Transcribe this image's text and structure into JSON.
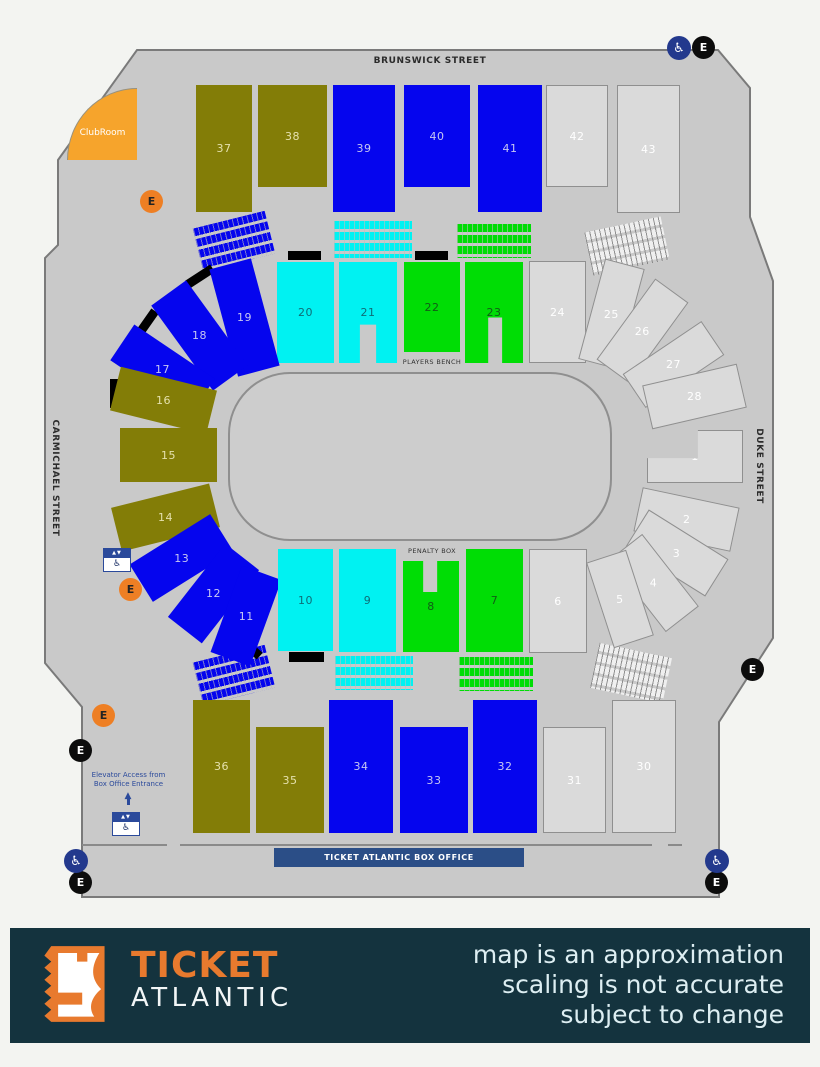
{
  "streets": {
    "top": "BRUNSWICK STREET",
    "left": "CARMICHAEL STREET",
    "right": "DUKE STREET"
  },
  "labels": {
    "club_room": "ClubRoom",
    "players_bench": "PLAYERS BENCH",
    "penalty_box": "PENALTY BOX",
    "box_office": "TICKET ATLANTIC BOX OFFICE",
    "elevator_note_line1": "Elevator Access from",
    "elevator_note_line2": "Box Office Entrance",
    "exit_letter": "E",
    "wheelchair_glyph": "♿",
    "elevator_top_glyph": "▲▼",
    "elevator_bottom_glyph": "♿",
    "arrow_glyph": "▲"
  },
  "footer": {
    "brand_line1": "TICKET",
    "brand_line2": "ATLANTIC",
    "disclaimer_lines": [
      "map is an approximation",
      "scaling is not accurate",
      "subject to change"
    ]
  },
  "colors": {
    "olive": "#837d07",
    "blue": "#0505ee",
    "cyan": "#00f2f2",
    "green": "#00dd05",
    "grey": "#dadada",
    "grey_border": "#8f8f8f",
    "building": "#c9c9c9",
    "building_border": "#7a7a7a",
    "orange": "#ee7f24",
    "clubroom_orange": "#f6a42c",
    "footer_navy": "#14333e",
    "footer_orange": "#e87a2e",
    "boxoffice_blue": "#2b4e87",
    "elevator_blue": "#2b4a9b",
    "wheelchair_blue": "#23398d",
    "label_on_olive": "#e5e1ad",
    "label_on_blue": "#c7c7f2",
    "label_on_cyan": "#0e6d77",
    "label_on_green": "#115c17",
    "label_on_grey": "#ffffff"
  },
  "building_outline": "137,50 718,50 750,88 750,217 773,281 773,638 719,722 719,897 82,897 82,707 45,663 45,258 58,245 58,160",
  "sections": [
    {
      "id": "37",
      "color": "olive",
      "x": 196,
      "y": 85,
      "w": 56,
      "h": 127
    },
    {
      "id": "38",
      "color": "olive",
      "x": 258,
      "y": 85,
      "w": 69,
      "h": 102
    },
    {
      "id": "39",
      "color": "blue",
      "x": 333,
      "y": 85,
      "w": 62,
      "h": 127
    },
    {
      "id": "40",
      "color": "blue",
      "x": 404,
      "y": 85,
      "w": 66,
      "h": 102
    },
    {
      "id": "41",
      "color": "blue",
      "x": 478,
      "y": 85,
      "w": 64,
      "h": 127
    },
    {
      "id": "42",
      "color": "grey",
      "x": 546,
      "y": 85,
      "w": 62,
      "h": 102,
      "border": true
    },
    {
      "id": "43",
      "color": "grey",
      "x": 617,
      "y": 85,
      "w": 63,
      "h": 128,
      "border": true
    },
    {
      "id": "20",
      "color": "cyan",
      "x": 277,
      "y": 262,
      "w": 57,
      "h": 101
    },
    {
      "id": "21",
      "color": "cyan",
      "x": 339,
      "y": 262,
      "w": 58,
      "h": 101,
      "clip": "polygon(0 0,100% 0,100% 100%,64% 100%,64% 62%,36% 62%,36% 100%,0 100%)"
    },
    {
      "id": "22",
      "color": "green",
      "x": 404,
      "y": 262,
      "w": 56,
      "h": 90
    },
    {
      "id": "23",
      "color": "green",
      "x": 465,
      "y": 262,
      "w": 58,
      "h": 101,
      "clip": "polygon(0 0,100% 0,100% 100%,64% 100%,64% 55%,40% 55%,40% 100%,0 100%)"
    },
    {
      "id": "24",
      "color": "grey",
      "x": 529,
      "y": 261,
      "w": 57,
      "h": 102,
      "border": true
    },
    {
      "id": "19",
      "color": "blue",
      "x": 223,
      "y": 262,
      "w": 43,
      "h": 111,
      "rot": -15
    },
    {
      "id": "18",
      "color": "blue",
      "x": 178,
      "y": 283,
      "w": 43,
      "h": 105,
      "rot": -36
    },
    {
      "id": "17",
      "color": "blue",
      "x": 141,
      "y": 321,
      "w": 43,
      "h": 97,
      "rot": -56
    },
    {
      "id": "16",
      "color": "olive",
      "x": 114,
      "y": 378,
      "w": 99,
      "h": 45,
      "rot": 14
    },
    {
      "id": "15",
      "color": "olive",
      "x": 120,
      "y": 428,
      "w": 97,
      "h": 54,
      "rot": 0
    },
    {
      "id": "14",
      "color": "olive",
      "x": 115,
      "y": 495,
      "w": 101,
      "h": 45,
      "rot": -14
    },
    {
      "id": "13",
      "color": "blue",
      "x": 134,
      "y": 536,
      "w": 95,
      "h": 44,
      "rot": -32
    },
    {
      "id": "12",
      "color": "blue",
      "x": 167,
      "y": 572,
      "w": 93,
      "h": 43,
      "rot": -52
    },
    {
      "id": "11",
      "color": "blue",
      "x": 225,
      "y": 570,
      "w": 42,
      "h": 92,
      "rot": 20
    },
    {
      "id": "25",
      "color": "grey",
      "x": 591,
      "y": 262,
      "w": 41,
      "h": 104,
      "rot": 15,
      "border": true
    },
    {
      "id": "26",
      "color": "grey",
      "x": 622,
      "y": 281,
      "w": 41,
      "h": 100,
      "rot": 36,
      "border": true
    },
    {
      "id": "27",
      "color": "grey",
      "x": 653,
      "y": 317,
      "w": 41,
      "h": 95,
      "rot": 56,
      "border": true
    },
    {
      "id": "28",
      "color": "grey",
      "x": 646,
      "y": 374,
      "w": 97,
      "h": 45,
      "rot": -13,
      "border": true
    },
    {
      "id": "1",
      "color": "grey",
      "x": 647,
      "y": 430,
      "w": 96,
      "h": 53,
      "border": true,
      "clip": "polygon(53% 0,100% 0,100% 100%,0 100%,0 53%,53% 53%)"
    },
    {
      "id": "2",
      "color": "grey",
      "x": 637,
      "y": 497,
      "w": 99,
      "h": 45,
      "rot": 12,
      "border": true
    },
    {
      "id": "3",
      "color": "grey",
      "x": 630,
      "y": 531,
      "w": 94,
      "h": 44,
      "rot": 32,
      "border": true
    },
    {
      "id": "4",
      "color": "grey",
      "x": 608,
      "y": 562,
      "w": 92,
      "h": 42,
      "rot": 52,
      "border": true
    },
    {
      "id": "5",
      "color": "grey",
      "x": 599,
      "y": 554,
      "w": 42,
      "h": 90,
      "rot": -18,
      "border": true
    },
    {
      "id": "10",
      "color": "cyan",
      "x": 278,
      "y": 549,
      "w": 55,
      "h": 102
    },
    {
      "id": "9",
      "color": "cyan",
      "x": 339,
      "y": 549,
      "w": 57,
      "h": 103
    },
    {
      "id": "8",
      "color": "green",
      "x": 403,
      "y": 561,
      "w": 56,
      "h": 91,
      "clip": "polygon(0 0,36% 0,36% 34%,61% 34%,61% 0,100% 0,100% 100%,0 100%)"
    },
    {
      "id": "7",
      "color": "green",
      "x": 466,
      "y": 549,
      "w": 57,
      "h": 103
    },
    {
      "id": "6",
      "color": "grey",
      "x": 529,
      "y": 549,
      "w": 58,
      "h": 104,
      "border": true
    },
    {
      "id": "36",
      "color": "olive",
      "x": 193,
      "y": 700,
      "w": 57,
      "h": 133
    },
    {
      "id": "35",
      "color": "olive",
      "x": 256,
      "y": 727,
      "w": 68,
      "h": 106
    },
    {
      "id": "34",
      "color": "blue",
      "x": 329,
      "y": 700,
      "w": 64,
      "h": 133
    },
    {
      "id": "33",
      "color": "blue",
      "x": 400,
      "y": 727,
      "w": 68,
      "h": 106
    },
    {
      "id": "32",
      "color": "blue",
      "x": 473,
      "y": 700,
      "w": 64,
      "h": 133
    },
    {
      "id": "31",
      "color": "grey",
      "x": 543,
      "y": 727,
      "w": 63,
      "h": 106,
      "border": true
    },
    {
      "id": "30",
      "color": "grey",
      "x": 612,
      "y": 700,
      "w": 64,
      "h": 133,
      "border": true
    }
  ],
  "seat_rows": [
    {
      "name": "top-left-rows",
      "color": "blue",
      "x": 197,
      "y": 219,
      "w": 74,
      "h": 44,
      "rot": -14
    },
    {
      "name": "top-center-left-rows",
      "color": "cyan",
      "x": 334,
      "y": 221,
      "w": 78,
      "h": 37,
      "rot": 0
    },
    {
      "name": "top-center-right-rows",
      "color": "green",
      "x": 457,
      "y": 224,
      "w": 74,
      "h": 34,
      "rot": 0
    },
    {
      "name": "top-right-rows",
      "color": "greyrow",
      "x": 588,
      "y": 224,
      "w": 78,
      "h": 44,
      "rot": -12
    },
    {
      "name": "bottom-left-rows",
      "color": "blue",
      "x": 197,
      "y": 653,
      "w": 74,
      "h": 44,
      "rot": -14
    },
    {
      "name": "bottom-center-left-rows",
      "color": "cyan",
      "x": 335,
      "y": 656,
      "w": 78,
      "h": 34,
      "rot": 0
    },
    {
      "name": "bottom-center-right-rows",
      "color": "green",
      "x": 459,
      "y": 657,
      "w": 74,
      "h": 34,
      "rot": 0
    },
    {
      "name": "bottom-right-rows",
      "color": "greyrow",
      "x": 594,
      "y": 650,
      "w": 74,
      "h": 46,
      "rot": 12
    }
  ],
  "black_bars": [
    {
      "x": 288,
      "y": 251,
      "w": 33,
      "h": 9,
      "rot": 0
    },
    {
      "x": 415,
      "y": 251,
      "w": 33,
      "h": 9,
      "rot": 0
    },
    {
      "x": 185,
      "y": 272,
      "w": 30,
      "h": 9,
      "rot": -33
    },
    {
      "x": 133,
      "y": 318,
      "w": 28,
      "h": 9,
      "rot": -55
    },
    {
      "x": 110,
      "y": 379,
      "w": 8,
      "h": 29,
      "rot": 0
    },
    {
      "x": 289,
      "y": 652,
      "w": 35,
      "h": 10,
      "rot": 0
    },
    {
      "x": 237,
      "y": 643,
      "w": 26,
      "h": 9,
      "rot": 42
    }
  ],
  "markers": [
    {
      "type": "e-orange",
      "cx": 152,
      "cy": 202
    },
    {
      "type": "e-orange",
      "cx": 131,
      "cy": 590
    },
    {
      "type": "e-orange",
      "cx": 104,
      "cy": 716
    },
    {
      "type": "e-black",
      "cx": 704,
      "cy": 48
    },
    {
      "type": "e-black",
      "cx": 753,
      "cy": 670
    },
    {
      "type": "e-black",
      "cx": 81,
      "cy": 751
    },
    {
      "type": "e-black",
      "cx": 81,
      "cy": 883
    },
    {
      "type": "e-black",
      "cx": 717,
      "cy": 883
    },
    {
      "type": "wheelchair",
      "cx": 679,
      "cy": 48
    },
    {
      "type": "wheelchair",
      "cx": 76,
      "cy": 861
    },
    {
      "type": "wheelchair",
      "cx": 717,
      "cy": 861
    }
  ],
  "elevator_icons": [
    {
      "x": 103,
      "y": 548
    },
    {
      "x": 112,
      "y": 812
    }
  ],
  "walk_lines": [
    {
      "x": 82,
      "y": 844,
      "w": 85
    },
    {
      "x": 180,
      "y": 844,
      "w": 472
    },
    {
      "x": 668,
      "y": 844,
      "w": 14
    }
  ]
}
